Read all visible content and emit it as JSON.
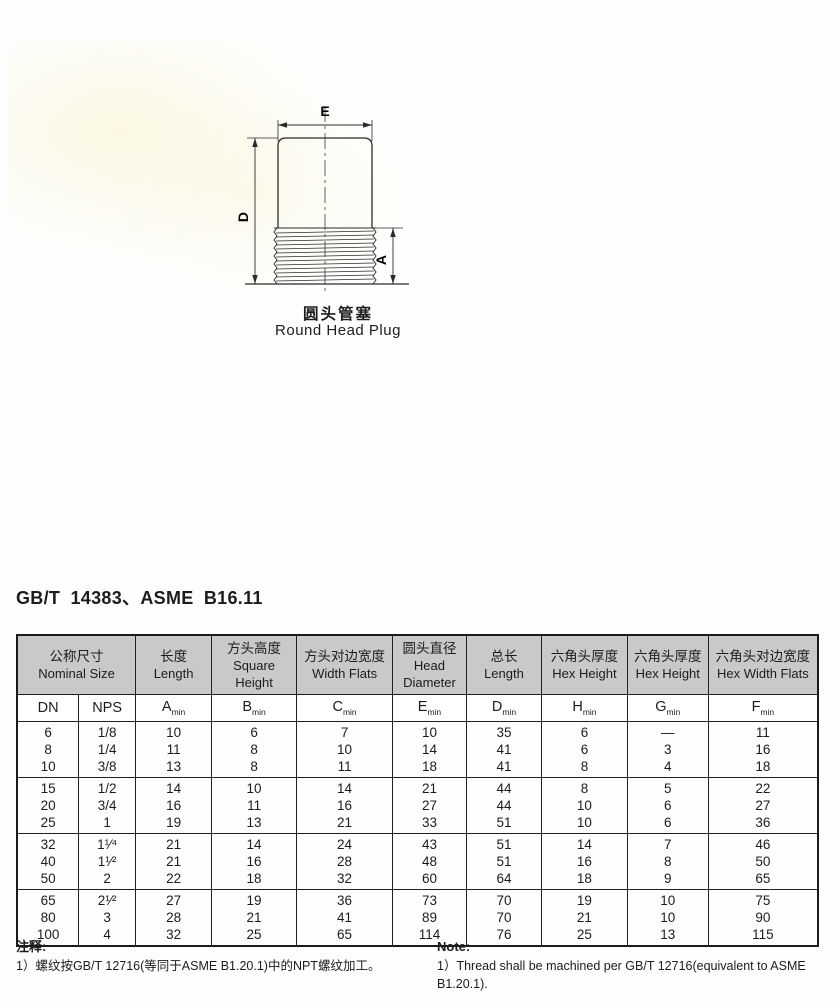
{
  "figure": {
    "dim_labels": {
      "e": "E",
      "d": "D",
      "a": "A"
    },
    "caption_zh": "圆头管塞",
    "caption_en": "Round Head Plug"
  },
  "heading": "GB/T 14383、ASME B16.11",
  "table": {
    "header": {
      "nominal": {
        "zh": "公称尺寸",
        "en": "Nominal Size"
      },
      "cols": [
        {
          "zh": "长度",
          "en": "Length"
        },
        {
          "zh": "方头高度",
          "en": "Square Height"
        },
        {
          "zh": "方头对边宽度",
          "en": "Width Flats"
        },
        {
          "zh": "圆头直径",
          "en": "Head Diameter"
        },
        {
          "zh": "总长",
          "en": "Length"
        },
        {
          "zh": "六角头厚度",
          "en": "Hex Height"
        },
        {
          "zh": "六角头厚度",
          "en": "Hex Height"
        },
        {
          "zh": "六角头对边宽度",
          "en": "Hex Width Flats"
        }
      ]
    },
    "subheader": {
      "dn": "DN",
      "nps": "NPS",
      "dims": [
        {
          "base": "A",
          "sub": "min"
        },
        {
          "base": "B",
          "sub": "min"
        },
        {
          "base": "C",
          "sub": "min"
        },
        {
          "base": "E",
          "sub": "min"
        },
        {
          "base": "D",
          "sub": "min"
        },
        {
          "base": "H",
          "sub": "min"
        },
        {
          "base": "G",
          "sub": "min"
        },
        {
          "base": "F",
          "sub": "min"
        }
      ]
    },
    "groups": [
      [
        [
          "6",
          "1/8",
          "10",
          "6",
          "7",
          "10",
          "35",
          "6",
          "—",
          "11"
        ],
        [
          "8",
          "1/4",
          "11",
          "8",
          "10",
          "14",
          "41",
          "6",
          "3",
          "16"
        ],
        [
          "10",
          "3/8",
          "13",
          "8",
          "11",
          "18",
          "41",
          "8",
          "4",
          "18"
        ]
      ],
      [
        [
          "15",
          "1/2",
          "14",
          "10",
          "14",
          "21",
          "44",
          "8",
          "5",
          "22"
        ],
        [
          "20",
          "3/4",
          "16",
          "11",
          "16",
          "27",
          "44",
          "10",
          "6",
          "27"
        ],
        [
          "25",
          "1",
          "19",
          "13",
          "21",
          "33",
          "51",
          "10",
          "6",
          "36"
        ]
      ],
      [
        [
          "32",
          "1¹⁄⁴",
          "21",
          "14",
          "24",
          "43",
          "51",
          "14",
          "7",
          "46"
        ],
        [
          "40",
          "1¹⁄²",
          "21",
          "16",
          "28",
          "48",
          "51",
          "16",
          "8",
          "50"
        ],
        [
          "50",
          "2",
          "22",
          "18",
          "32",
          "60",
          "64",
          "18",
          "9",
          "65"
        ]
      ],
      [
        [
          "65",
          "2¹⁄²",
          "27",
          "19",
          "36",
          "73",
          "70",
          "19",
          "10",
          "75"
        ],
        [
          "80",
          "3",
          "28",
          "21",
          "41",
          "89",
          "70",
          "21",
          "10",
          "90"
        ],
        [
          "100",
          "4",
          "32",
          "25",
          "65",
          "114",
          "76",
          "25",
          "13",
          "115"
        ]
      ]
    ]
  },
  "notes": {
    "zh": {
      "title": "注释:",
      "item": "1）螺纹按GB/T 12716(等同于ASME B1.20.1)中的NPT螺纹加工。"
    },
    "en": {
      "title": "Note:",
      "item": "1）Thread shall be machined per GB/T 12716(equivalent to ASME B1.20.1)."
    }
  },
  "colors": {
    "header_bg": "#c9c9c9",
    "line": "#1f1f1f"
  }
}
